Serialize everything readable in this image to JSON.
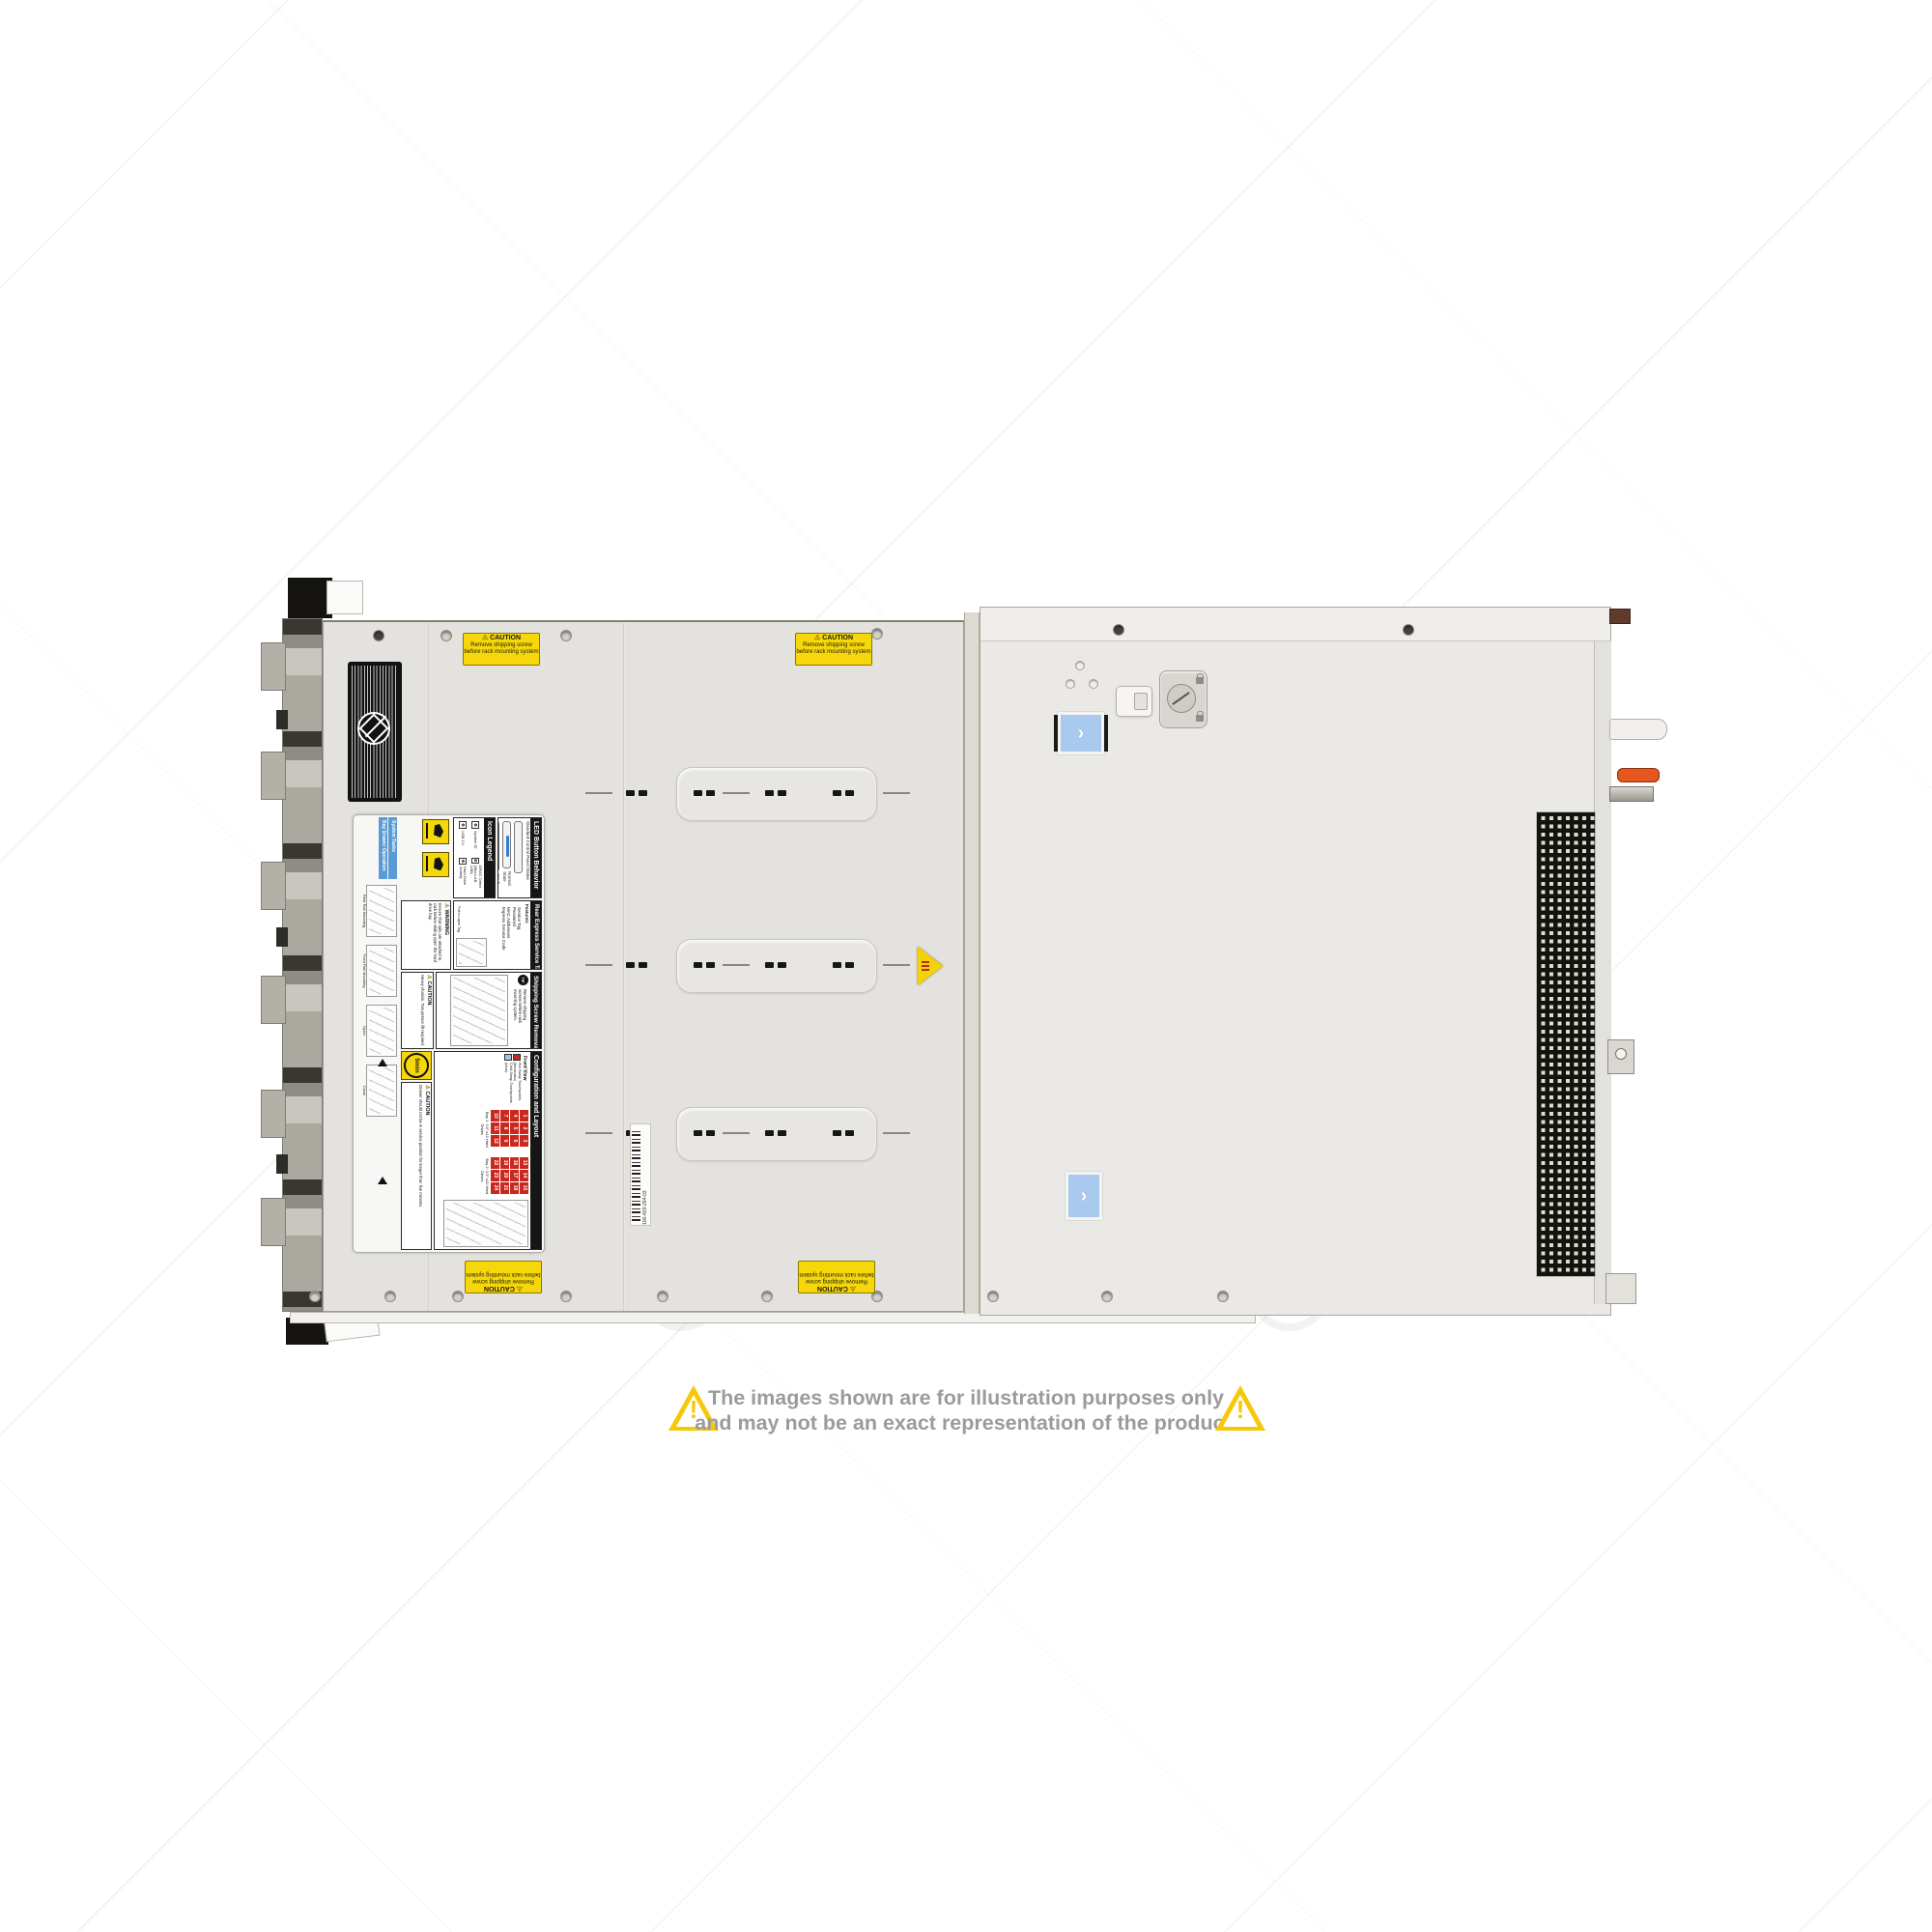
{
  "watermark": {
    "text": "COMPAN",
    "logo_name": "cj-ring-logo"
  },
  "disclaimer": {
    "line1": "The images shown are for illustration purposes only",
    "line2": "and may not be an exact representation of the product."
  },
  "stickers": {
    "caution_shipping": {
      "title": "CAUTION",
      "line1": "Remove shipping screw",
      "line2": "before rack mounting system"
    }
  },
  "barcode": {
    "text": "100-400-294-03"
  },
  "service_label": {
    "system_tasks": {
      "header": "System Tasks",
      "subheader": "Bay Drawer Operation",
      "steps": [
        "Rear Rail Mounting",
        "Front Rail Mounting",
        "Open",
        "Close"
      ]
    },
    "warning_rails": {
      "title": "WARNING",
      "text": "Ensure that rails are attached to rack before sliding open the hard drive bay."
    },
    "icon_legend": {
      "title": "Icon Legend",
      "items": [
        "System ID",
        "iDRAC Direct (Micro-AB USB)",
        "USB 2.0",
        "Hard Drive Activity"
      ]
    },
    "led": {
      "title": "LED Button Behavior",
      "subtitle": "Standard Control Panel Status",
      "states": [
        {
          "label": "Normal State",
          "color": "#2f7fd0"
        },
        {
          "label": "Fault State",
          "color": "#f09a1f"
        }
      ]
    },
    "rear_tag": {
      "title": "Rear Express Service Tag",
      "features_label": "Features:",
      "features": [
        "Service Tag",
        "Password",
        "MAC Addresses",
        "Express Service Code"
      ],
      "note": "Pull to open Tag"
    },
    "shipping": {
      "title": "Shipping Screw Removal",
      "tip": "TIP",
      "text": "Remove shipping screws before rack mounting system."
    },
    "config": {
      "title": "Configuration and Layout",
      "front_view": "Front View",
      "legend": [
        {
          "label": "Hot Swap Touchpoints (terracotta)",
          "color": "#c8281e"
        },
        {
          "label": "Cold Swap Touchpoints (blue)",
          "color": "#9fc4e8"
        }
      ],
      "bays": [
        {
          "label": "Bay 1: 3.5\" x12 Hard Drives",
          "rows": [
            [
              1,
              2,
              3
            ],
            [
              4,
              5,
              6
            ],
            [
              7,
              8,
              9
            ],
            [
              10,
              11,
              12
            ]
          ]
        },
        {
          "label": "Bay 2: 3.5\" x12 Hard Drives",
          "rows": [
            [
              13,
              14,
              15
            ],
            [
              16,
              17,
              18
            ],
            [
              19,
              20,
              21
            ],
            [
              22,
              23,
              24
            ]
          ]
        }
      ]
    },
    "caution_heavy": {
      "title": "CAUTION",
      "text": "Heavy chassis. Two person lift required."
    },
    "caution_drawer": {
      "title": "CAUTION",
      "text": "Drawer should not be in service position for longer than five minutes.",
      "timer": "5min"
    }
  }
}
